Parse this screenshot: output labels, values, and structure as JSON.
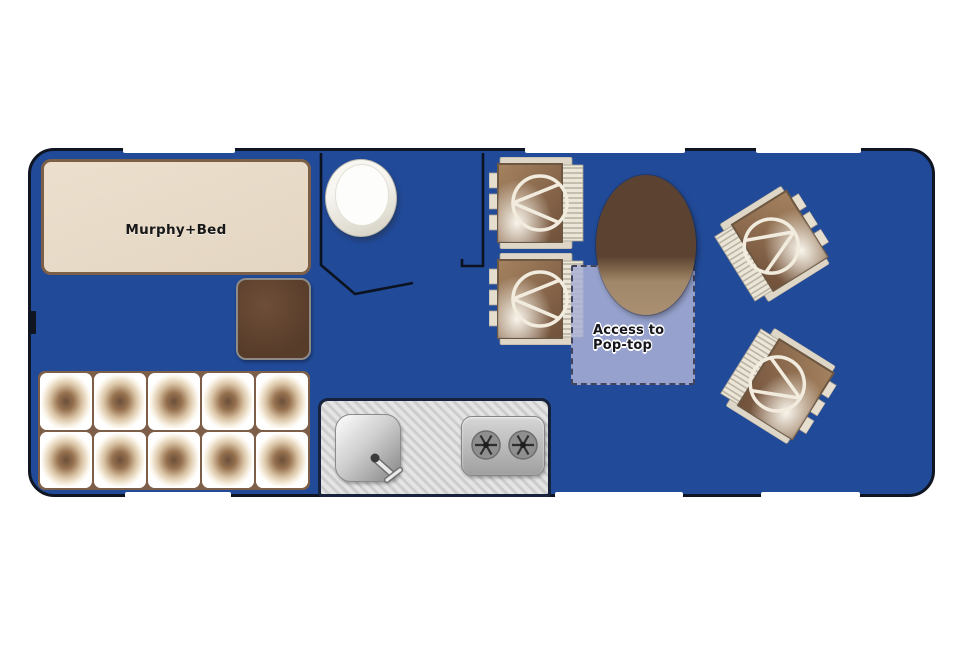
{
  "title": "Campervan floor plan",
  "vehicle": {
    "body_color": "#214a98",
    "outline_color": "#0f1522",
    "labels": {
      "murphy_bed": "Murphy+Bed",
      "pop_top_line1": "Access to",
      "pop_top_line2": "Pop-top"
    },
    "furniture": [
      {
        "name": "murphy-bed",
        "label": "Murphy+Bed"
      },
      {
        "name": "toilet"
      },
      {
        "name": "bathroom-walls"
      },
      {
        "name": "ottoman"
      },
      {
        "name": "storage-cushions",
        "cells": 10
      },
      {
        "name": "kitchen-counter"
      },
      {
        "name": "sink",
        "features": [
          "drain",
          "faucet"
        ]
      },
      {
        "name": "stove",
        "burners": 2
      },
      {
        "name": "dinette-chair-front"
      },
      {
        "name": "dinette-chair-rear"
      },
      {
        "name": "cab-seat-upper"
      },
      {
        "name": "cab-seat-lower"
      },
      {
        "name": "dining-table"
      },
      {
        "name": "pop-top-access-zone",
        "label": "Access to Pop-top"
      }
    ],
    "colors": {
      "bed_fill": "#e8dcca",
      "bed_border": "#7c5f47",
      "wood_dark": "#5c4231",
      "wood_light": "#a98e6d",
      "cushion_light": "#f7efe0",
      "counter_gray": "#d6d6d6",
      "pop_top_overlay": "#aab1d6",
      "chair_seat": "#8a6a4c",
      "chair_trim": "#e6dfd0"
    }
  }
}
